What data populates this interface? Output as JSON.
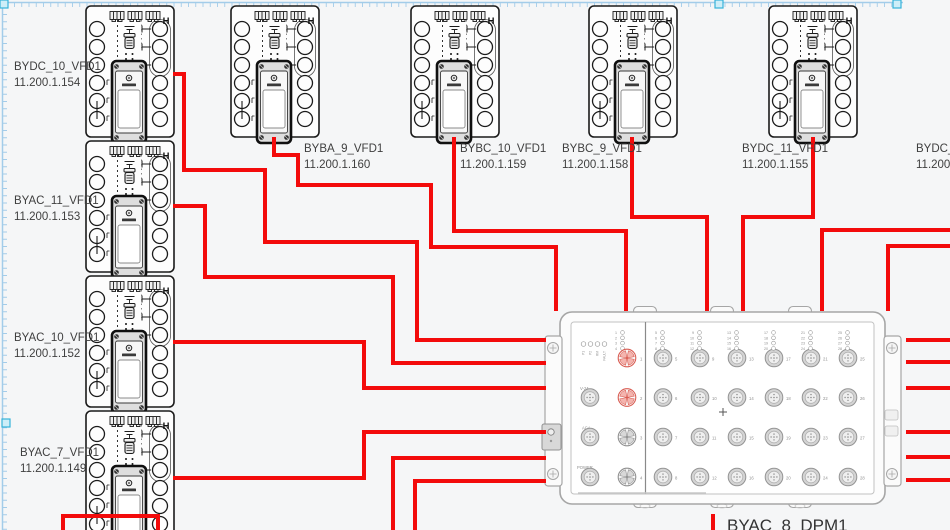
{
  "canvas": {
    "width": 950,
    "height": 530,
    "colors": {
      "bg": "#f5f6f7",
      "cable": "#f30b0b",
      "ink": "#1b1b1b",
      "guide": "#a3cce9",
      "handle_fill": "#cdeef8",
      "handle_stroke": "#36b3d9",
      "dpm_line": "#a6a6a6",
      "label": "#3f3f3f",
      "port_active": "#d95c52",
      "port_active_fill": "#f4b4ae",
      "port_gray": "#8f8f8f",
      "port_gray_fill": "#d8d8d8"
    }
  },
  "vfd_art": {
    "corner_mark": "H"
  },
  "devices": [
    {
      "name": "BYDC_10_VFD1",
      "ip": "11.200.1.154",
      "x": 85,
      "y": 5,
      "label_x": 14,
      "label_y": 70,
      "offscreen": false
    },
    {
      "name": "BYAC_11_VFD1",
      "ip": "11.200.1.153",
      "x": 85,
      "y": 140,
      "label_x": 14,
      "label_y": 204,
      "offscreen": false
    },
    {
      "name": "BYAC_10_VFD1",
      "ip": "11.200.1.152",
      "x": 85,
      "y": 275,
      "label_x": 14,
      "label_y": 341,
      "offscreen": false
    },
    {
      "name": "BYAC_7_VFD1",
      "ip": "11.200.1.149",
      "x": 85,
      "y": 410,
      "label_x": 20,
      "label_y": 456,
      "offscreen": false
    },
    {
      "name": "BYBA_9_VFD1",
      "ip": "11.200.1.160",
      "x": 230,
      "y": 5,
      "label_x": 304,
      "label_y": 152,
      "offscreen": false
    },
    {
      "name": "BYBC_10_VFD1",
      "ip": "11.200.1.159",
      "x": 410,
      "y": 5,
      "label_x": 460,
      "label_y": 152,
      "offscreen": false
    },
    {
      "name": "BYBC_9_VFD1",
      "ip": "11.200.1.158",
      "x": 588,
      "y": 5,
      "label_x": 562,
      "label_y": 152,
      "offscreen": false
    },
    {
      "name": "BYDC_11_VFD1",
      "ip": "11.200.1.155",
      "x": 768,
      "y": 5,
      "label_x": 742,
      "label_y": 152,
      "offscreen": false
    },
    {
      "name": "BYDC_12",
      "ip": "11.200.1",
      "x": 960,
      "y": 5,
      "label_x": 916,
      "label_y": 152,
      "offscreen": true
    }
  ],
  "dpm": {
    "name": "BYAC_8_DPM1",
    "label_x": 727,
    "label_y": 531,
    "status_leds": [
      "P1",
      "P2",
      "RM",
      "FAULT"
    ],
    "aux_ports": [
      "V-24",
      "ACA",
      "POWER"
    ],
    "fan_ports": [
      {
        "n": "1",
        "active": true
      },
      {
        "n": "2",
        "active": true
      },
      {
        "n": "3",
        "active": false
      },
      {
        "n": "4",
        "active": false
      }
    ],
    "led_group_port1": [
      "1",
      "2",
      "3",
      "4"
    ],
    "grid_port_numbers": [
      [
        "5",
        "6",
        "7",
        "8"
      ],
      [
        "9",
        "10",
        "11",
        "12"
      ],
      [
        "13",
        "14",
        "15",
        "16"
      ],
      [
        "17",
        "18",
        "19",
        "20"
      ],
      [
        "21",
        "22",
        "23",
        "24"
      ],
      [
        "25",
        "26",
        "27",
        "28"
      ]
    ]
  },
  "cables": [
    {
      "points": [
        [
          173,
          74
        ],
        [
          184,
          74
        ],
        [
          184,
          170
        ],
        [
          265,
          170
        ],
        [
          265,
          242
        ],
        [
          417,
          242
        ],
        [
          417,
          340
        ],
        [
          546,
          340
        ]
      ]
    },
    {
      "points": [
        [
          173,
          206
        ],
        [
          205,
          206
        ],
        [
          205,
          277
        ],
        [
          393,
          277
        ],
        [
          393,
          363
        ],
        [
          546,
          363
        ]
      ]
    },
    {
      "points": [
        [
          173,
          342
        ],
        [
          364,
          342
        ],
        [
          364,
          388
        ],
        [
          546,
          388
        ]
      ]
    },
    {
      "points": [
        [
          173,
          478
        ],
        [
          364,
          478
        ],
        [
          364,
          432
        ],
        [
          546,
          432
        ]
      ]
    },
    {
      "points": [
        [
          393,
          532
        ],
        [
          393,
          458
        ],
        [
          546,
          458
        ]
      ]
    },
    {
      "points": [
        [
          415,
          532
        ],
        [
          415,
          481
        ],
        [
          546,
          481
        ]
      ]
    },
    {
      "points": [
        [
          274,
          137
        ],
        [
          274,
          155
        ],
        [
          298,
          155
        ],
        [
          298,
          185
        ],
        [
          431,
          185
        ],
        [
          431,
          247
        ],
        [
          556,
          247
        ],
        [
          556,
          311
        ]
      ]
    },
    {
      "points": [
        [
          454,
          137
        ],
        [
          454,
          231
        ],
        [
          626,
          231
        ],
        [
          626,
          311
        ]
      ]
    },
    {
      "points": [
        [
          632,
          137
        ],
        [
          632,
          217
        ],
        [
          707,
          217
        ],
        [
          707,
          311
        ]
      ]
    },
    {
      "points": [
        [
          813,
          137
        ],
        [
          813,
          217
        ],
        [
          743,
          217
        ],
        [
          743,
          311
        ]
      ]
    },
    {
      "points": [
        [
          952,
          230
        ],
        [
          822,
          230
        ],
        [
          822,
          311
        ]
      ]
    },
    {
      "points": [
        [
          952,
          246
        ],
        [
          888,
          246
        ],
        [
          888,
          311
        ]
      ]
    },
    {
      "points": [
        [
          906,
          340
        ],
        [
          952,
          340
        ]
      ]
    },
    {
      "points": [
        [
          906,
          362
        ],
        [
          952,
          362
        ]
      ]
    },
    {
      "points": [
        [
          906,
          388
        ],
        [
          952,
          388
        ]
      ]
    },
    {
      "points": [
        [
          906,
          432
        ],
        [
          952,
          432
        ]
      ]
    },
    {
      "points": [
        [
          906,
          457
        ],
        [
          952,
          457
        ]
      ]
    },
    {
      "points": [
        [
          906,
          480
        ],
        [
          952,
          480
        ]
      ]
    },
    {
      "points": [
        [
          713,
          514
        ],
        [
          713,
          532
        ]
      ]
    },
    {
      "points": [
        [
          63,
          532
        ],
        [
          63,
          516
        ],
        [
          158,
          516
        ],
        [
          158,
          532
        ]
      ]
    }
  ],
  "guides": {
    "top_length": 903,
    "left_length": 530,
    "handles": [
      [
        0,
        0
      ],
      [
        715,
        0
      ],
      [
        893,
        0
      ],
      [
        2,
        419
      ]
    ]
  }
}
